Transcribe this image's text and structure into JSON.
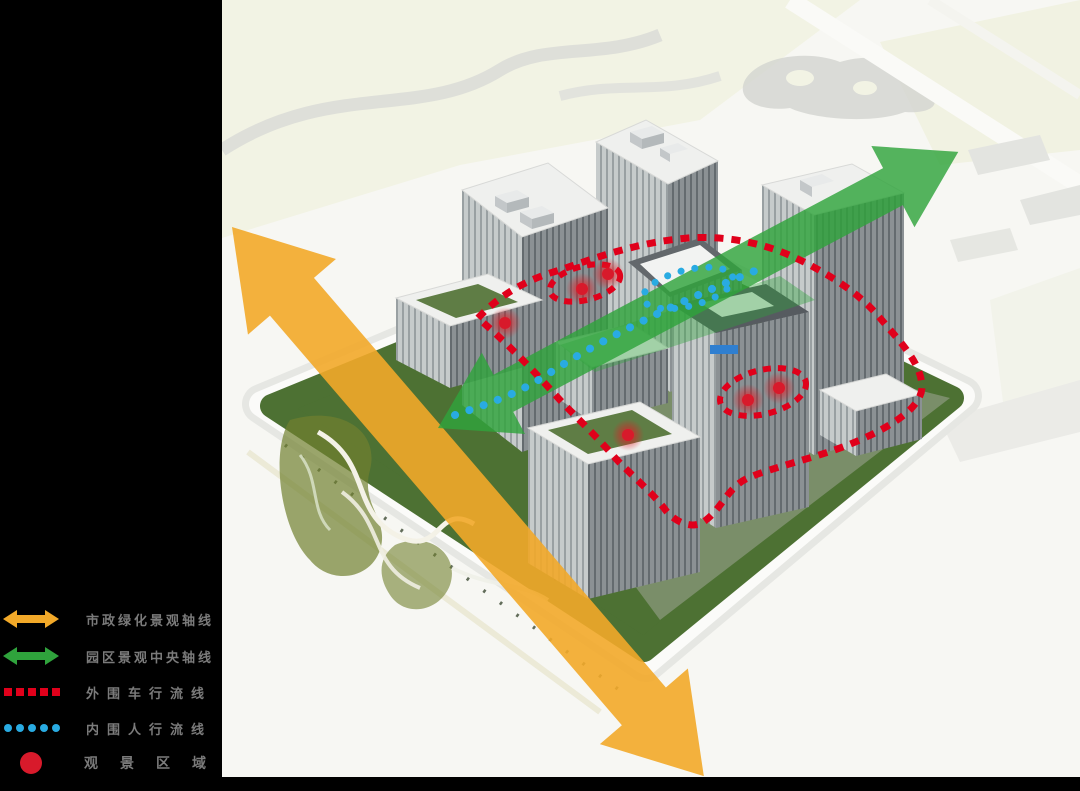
{
  "canvas": {
    "background": "#000000",
    "map_background": "#f7f7f3",
    "site_green": "#4d7133"
  },
  "legend": {
    "items": [
      {
        "id": "municipal-green-axis",
        "label": "市政绿化景观轴线",
        "color": "#F2A929",
        "type": "double-arrow"
      },
      {
        "id": "park-central-axis",
        "label": "园区景观中央轴线",
        "color": "#2FA33C",
        "type": "double-arrow"
      },
      {
        "id": "outer-vehicle-route",
        "label": "外围车行流线",
        "color": "#E0001B",
        "type": "dashed-line"
      },
      {
        "id": "inner-pedestrian-route",
        "label": "内围人行流线",
        "color": "#29ABE2",
        "type": "dotted-line"
      },
      {
        "id": "viewing-area",
        "label": "观景区域",
        "color": "#D81A2B",
        "type": "filled-circle"
      }
    ]
  }
}
